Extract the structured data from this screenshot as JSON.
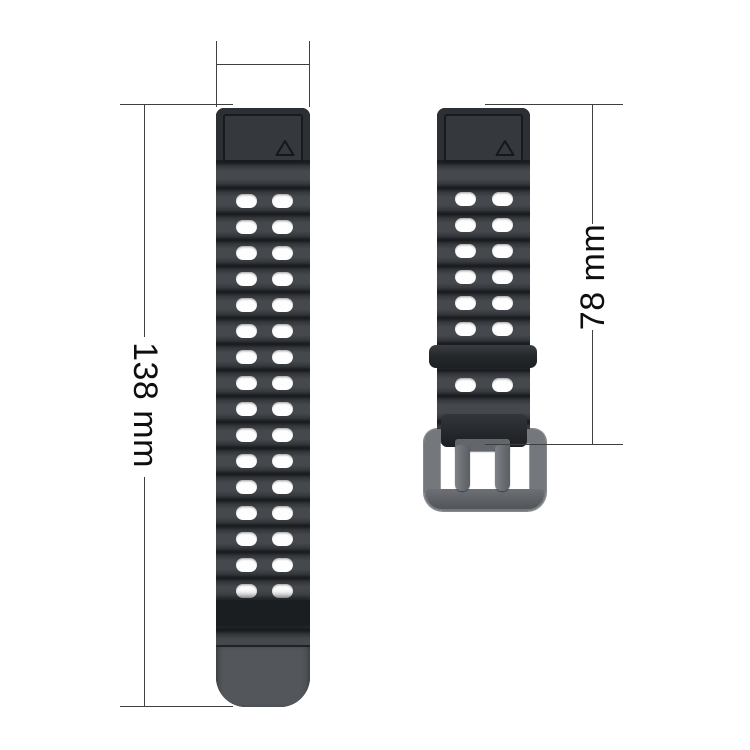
{
  "product": {
    "name": "silicone watch band with buckle",
    "left_strap": {
      "description": "long tail strap with two columns of holes",
      "hole_rows": 16,
      "hole_columns": 2,
      "triangle_marker": true
    },
    "right_strap": {
      "description": "short buckle strap",
      "hole_rows_above_keeper": 6,
      "hole_rows_below_keeper": 1,
      "hole_columns": 2,
      "has_keeper_loop": true,
      "has_buckle": true,
      "triangle_marker": true
    }
  },
  "annotations": {
    "left_length_label": "138 mm",
    "right_length_label": "78 mm",
    "width_bracket_label": ""
  },
  "colors": {
    "background": "#ffffff",
    "strap_body": "#3e4145",
    "strap_groove": "#17191c",
    "strap_lug": "#2c2f33",
    "strap_tail_tip": "#53565a",
    "hole": "#fefefe",
    "buckle_metal": "#74787c",
    "dimension_line": "#3f3f3f",
    "label_text": "#0f0f0f"
  }
}
